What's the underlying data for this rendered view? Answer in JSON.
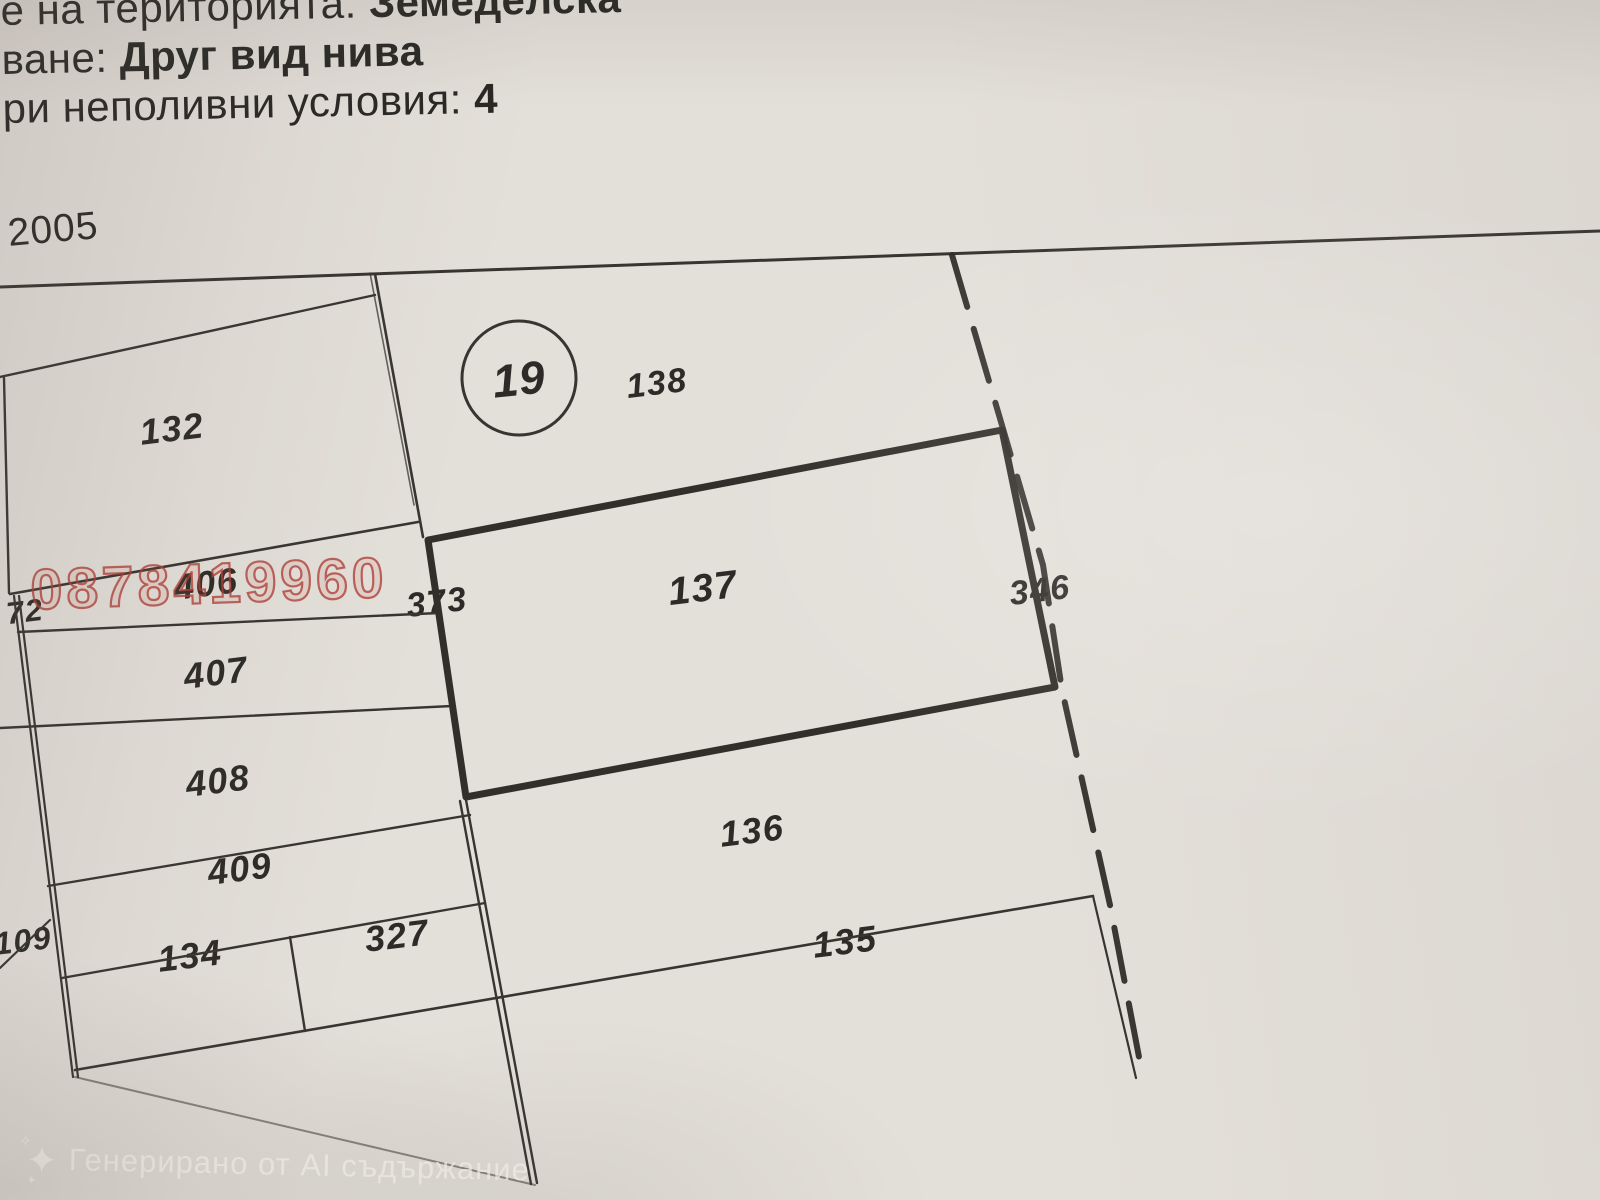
{
  "document": {
    "header_lines": [
      {
        "segments": [
          {
            "text": "е на територията: ",
            "bold": false
          },
          {
            "text": "Земеделска",
            "bold": true
          }
        ]
      },
      {
        "segments": [
          {
            "text": "ване: ",
            "bold": false
          },
          {
            "text": "Друг вид нива",
            "bold": true
          }
        ]
      },
      {
        "segments": [
          {
            "text": "ри неполивни условия: ",
            "bold": false
          },
          {
            "text": "4",
            "bold": true
          }
        ]
      }
    ],
    "year_label": "2005"
  },
  "map": {
    "zone_circle": {
      "number": "19"
    },
    "highlighted_parcel": "137",
    "parcels": [
      {
        "label": "132",
        "x": 172,
        "y": 429,
        "font_size": 36
      },
      {
        "label": "138",
        "x": 657,
        "y": 384,
        "font_size": 34
      },
      {
        "label": "406",
        "x": 206,
        "y": 584,
        "font_size": 36
      },
      {
        "label": "72",
        "x": 25,
        "y": 612,
        "font_size": 31
      },
      {
        "label": "373",
        "x": 437,
        "y": 603,
        "font_size": 34
      },
      {
        "label": "137",
        "x": 703,
        "y": 589,
        "font_size": 39
      },
      {
        "label": "346",
        "x": 1040,
        "y": 591,
        "font_size": 34
      },
      {
        "label": "407",
        "x": 216,
        "y": 673,
        "font_size": 36
      },
      {
        "label": "408",
        "x": 218,
        "y": 781,
        "font_size": 36
      },
      {
        "label": "409",
        "x": 240,
        "y": 869,
        "font_size": 36
      },
      {
        "label": "109",
        "x": 23,
        "y": 941,
        "font_size": 32
      },
      {
        "label": "134",
        "x": 190,
        "y": 956,
        "font_size": 36
      },
      {
        "label": "327",
        "x": 397,
        "y": 936,
        "font_size": 36
      },
      {
        "label": "136",
        "x": 752,
        "y": 831,
        "font_size": 36
      },
      {
        "label": "135",
        "x": 845,
        "y": 942,
        "font_size": 36
      }
    ]
  },
  "watermarks": {
    "phone": {
      "text": "0878419960",
      "color": "#ae3e36"
    },
    "ai_badge": {
      "text": "Генерирано от AI съдържание"
    }
  },
  "colors": {
    "paper": "#e3dfd9",
    "ink": "#34312c",
    "thick_boundary": "#322f2a"
  }
}
